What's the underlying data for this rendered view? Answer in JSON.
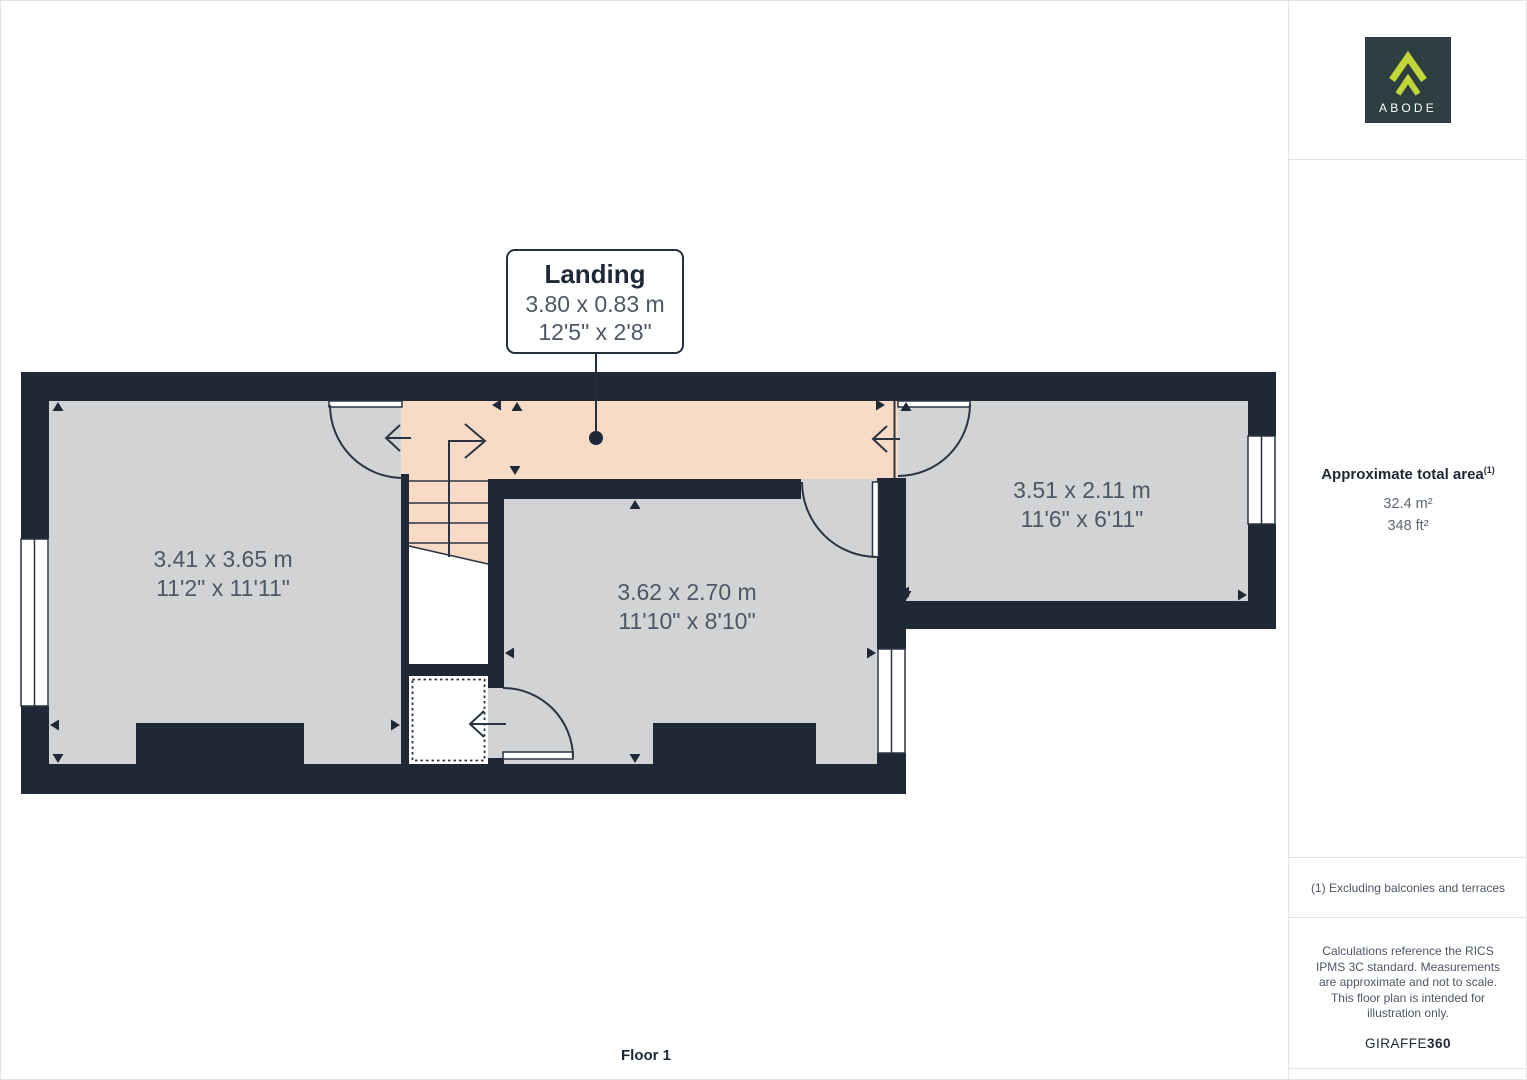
{
  "page": {
    "floor_label": "Floor 1"
  },
  "callout": {
    "room": "Landing",
    "metric": "3.80 x 0.83 m",
    "imperial": "12'5\" x 2'8\""
  },
  "rooms": [
    {
      "metric": "3.41 x 3.65 m",
      "imperial": "11'2\" x 11'11\""
    },
    {
      "metric": "3.62 x 2.70 m",
      "imperial": "11'10\" x 8'10\""
    },
    {
      "metric": "3.51 x 2.11 m",
      "imperial": "11'6\" x 6'11\""
    }
  ],
  "sidebar": {
    "logo_text": "ABODE",
    "area_title": "Approximate total area",
    "area_superscript": "(1)",
    "area_m2": "32.4 m²",
    "area_ft2": "348 ft²",
    "footnote": "(1) Excluding balconies and terraces",
    "disclaimer": "Calculations reference the RICS IPMS 3C standard. Measurements are approximate and not to scale. This floor plan is intended for illustration only.",
    "brand": "GIRAFFE",
    "brand_bold": "360"
  },
  "colors": {
    "wall": "#1e2836",
    "floor_gray": "#d2d3d5",
    "landing_pink": "#f8dbc6",
    "line": "#2a3442",
    "logo_bg": "#2d3f41",
    "logo_accent": "#c3d637"
  }
}
